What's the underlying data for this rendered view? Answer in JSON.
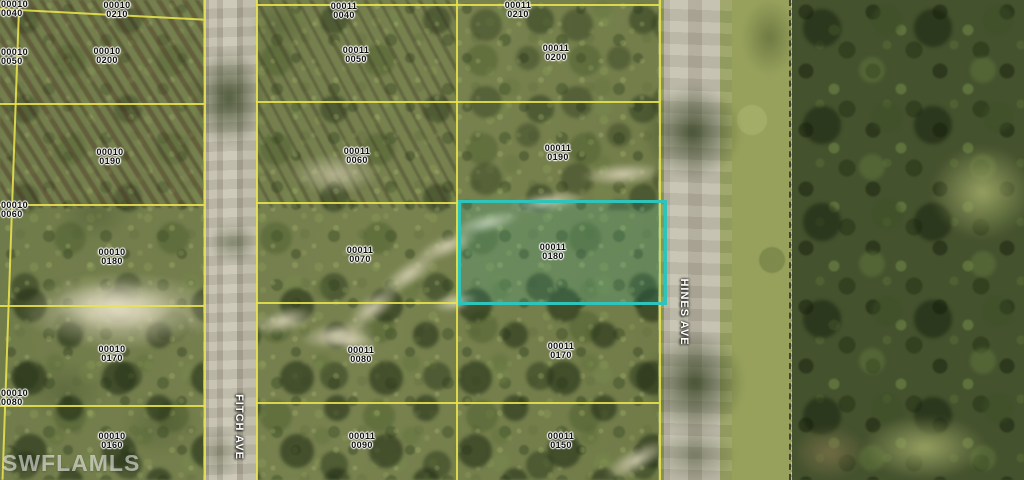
{
  "watermark": {
    "text": "SWFLAMLS"
  },
  "streets": {
    "fitch": {
      "label": "FITCH AVE"
    },
    "hines": {
      "label": "HINES AVE"
    }
  },
  "highlight": {
    "block": "00011",
    "lot": "0180",
    "border_color": "#2ec4bc"
  },
  "labels": [
    {
      "block": "00010",
      "lot": "0040"
    },
    {
      "block": "00010",
      "lot": "0050"
    },
    {
      "block": "00010",
      "lot": "0060"
    },
    {
      "block": "00010",
      "lot": "0080"
    },
    {
      "block": "00010",
      "lot": "0210"
    },
    {
      "block": "00010",
      "lot": "0200"
    },
    {
      "block": "00010",
      "lot": "0190"
    },
    {
      "block": "00010",
      "lot": "0180"
    },
    {
      "block": "00010",
      "lot": "0170"
    },
    {
      "block": "00010",
      "lot": "0160"
    },
    {
      "block": "00011",
      "lot": "0040"
    },
    {
      "block": "00011",
      "lot": "0050"
    },
    {
      "block": "00011",
      "lot": "0060"
    },
    {
      "block": "00011",
      "lot": "0070"
    },
    {
      "block": "00011",
      "lot": "0080"
    },
    {
      "block": "00011",
      "lot": "0090"
    },
    {
      "block": "00011",
      "lot": "0210"
    },
    {
      "block": "00011",
      "lot": "0200"
    },
    {
      "block": "00011",
      "lot": "0190"
    },
    {
      "block": "00011",
      "lot": "0170"
    },
    {
      "block": "00011",
      "lot": "0150"
    }
  ],
  "colors": {
    "parcel_line": "#e9e44e",
    "highlight_border": "#2ec4bc",
    "road": "#b8b4a3",
    "forest_dark": "#45522e",
    "field_olive": "#74804c"
  }
}
